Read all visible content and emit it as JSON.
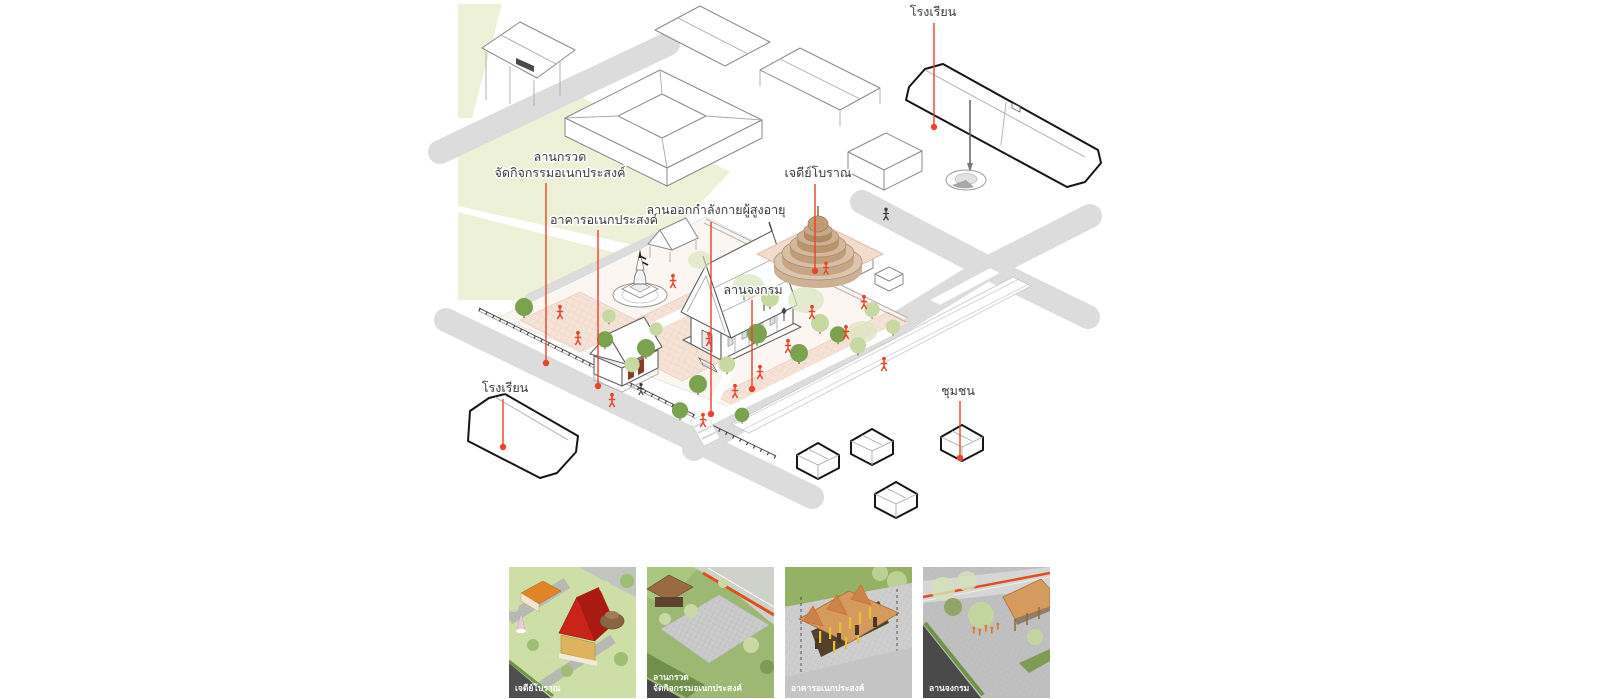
{
  "callouts": {
    "school_top": "โรงเรียน",
    "gravel_yard_line1": "ลานกรวด",
    "gravel_yard_line2": "จัดกิจกรรมอเนกประสงค์",
    "multipurpose_building": "อาคารอเนกประสงค์",
    "elderly_exercise_yard": "ลานออกกำลังกายผู้สูงอายุ",
    "ancient_chedi": "เจดีย์โบราณ",
    "walking_meditation_yard": "ลานจงกรม",
    "school_bottom": "โรงเรียน",
    "community": "ชุมชน"
  },
  "thumbnails": [
    {
      "caption_lines": [
        "เจดีย์โบราณ"
      ]
    },
    {
      "caption_lines": [
        "ลานกรวด",
        "จัดกิจกรรมอเนกประสงค์"
      ]
    },
    {
      "caption_lines": [
        "อาคารอเนกประสงค์"
      ]
    },
    {
      "caption_lines": [
        "ลานจงกรม"
      ]
    }
  ],
  "colors": {
    "leader_red": "#e8432e",
    "grass": "#edf1d7",
    "road_gray": "#dcdcdc",
    "courtyard_paving": "#f6e3d8",
    "ancient_chedi_tan": "#cdb194",
    "tree_dark_green": "#7aa24f",
    "tree_light_green": "#c8d8a3",
    "figure_orange": "#e8442a",
    "building_outline_black": "#161616",
    "temple_roof_red": "#c8241a",
    "pavilion_roof_tan": "#d59a5e"
  }
}
